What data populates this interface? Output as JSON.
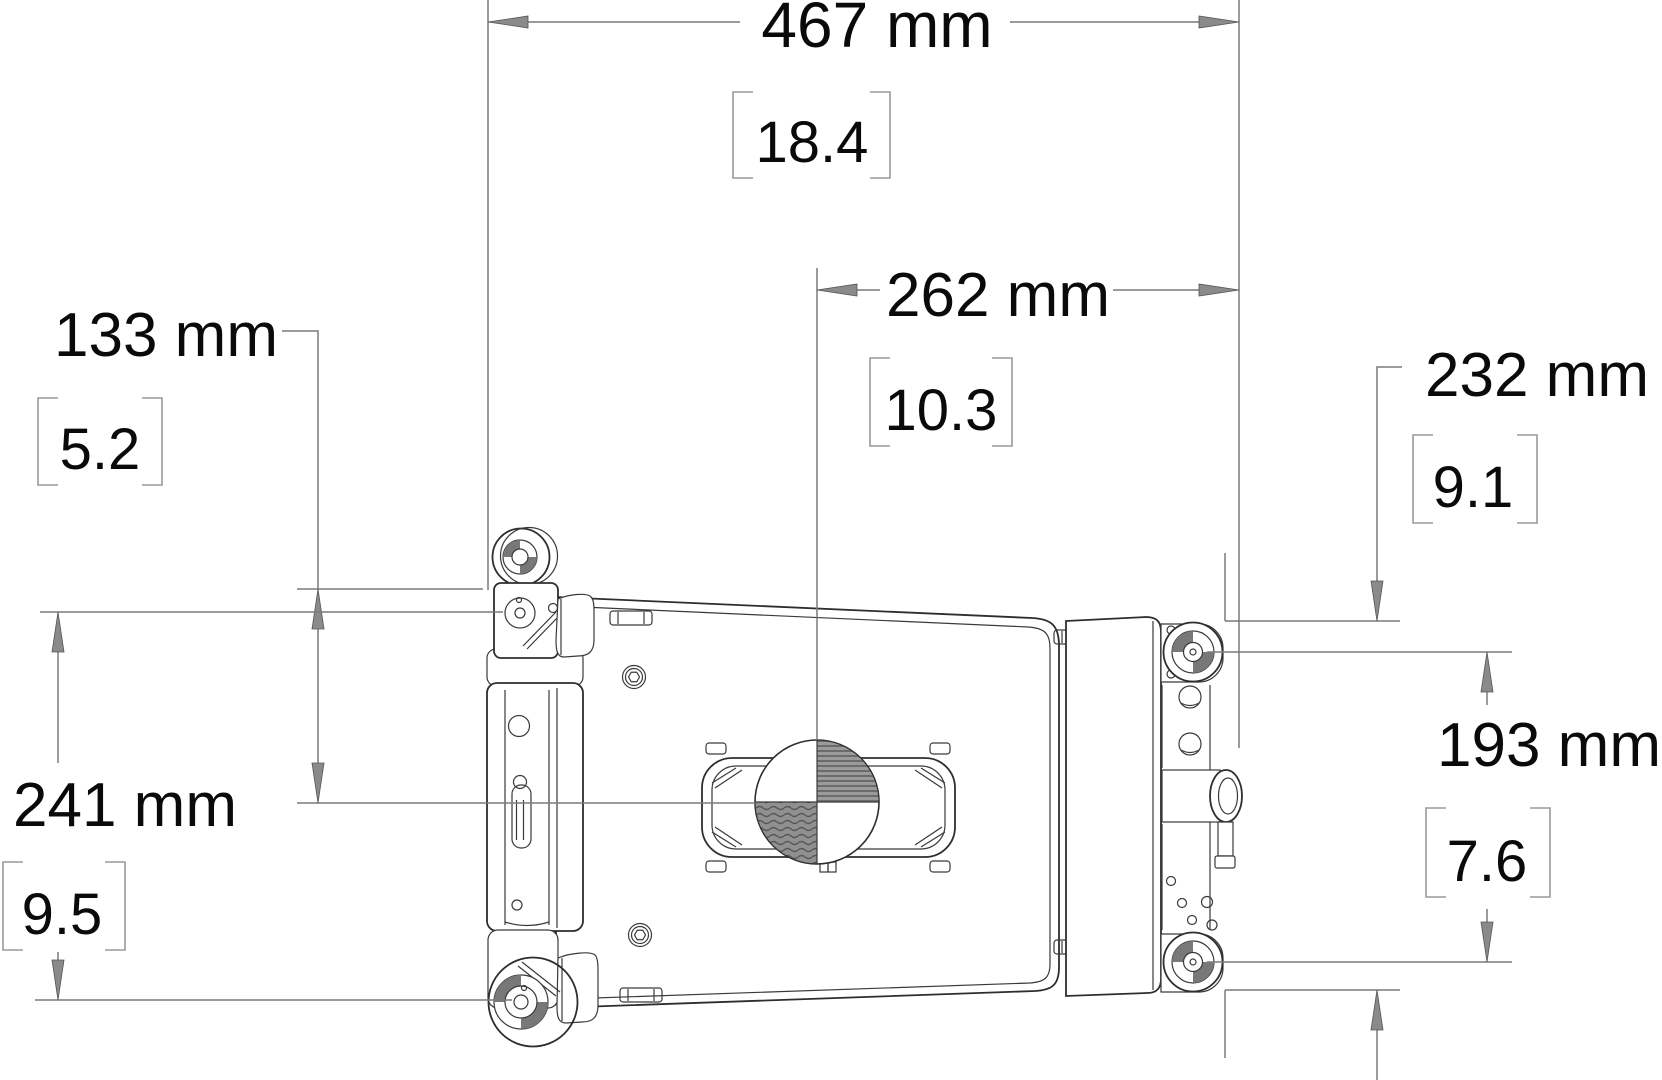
{
  "dims": {
    "overall_width": {
      "mm": "467 mm",
      "inches": "18.4"
    },
    "cg_from_right": {
      "mm": "262 mm",
      "inches": "10.3"
    },
    "cg_below_top": {
      "mm": "133 mm",
      "inches": "5.2"
    },
    "left_hole_span": {
      "mm": "241 mm",
      "inches": "9.5"
    },
    "right_top_offset": {
      "mm": "232 mm",
      "inches": "9.1"
    },
    "right_hole_span": {
      "mm": "193 mm",
      "inches": "7.6"
    }
  },
  "colors": {
    "dimension_line": "#7a7a7a",
    "part_line": "#2e2e2e",
    "text": "#0a0a0a",
    "hatch_dark": "#6b6b6b",
    "hatch_base": "#9a9a9a"
  }
}
